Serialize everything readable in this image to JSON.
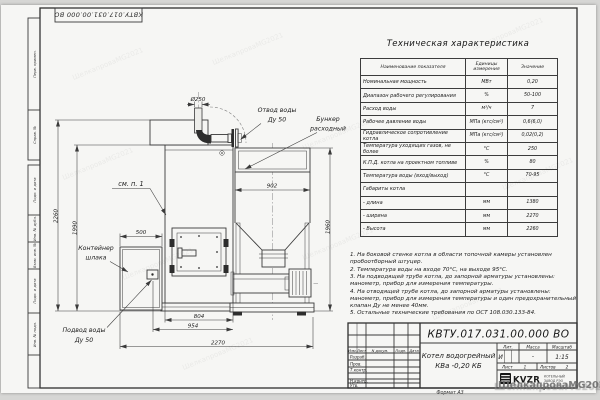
{
  "sheet": {
    "stamp_top": "КВТУ.017.031.00.000 ВО",
    "format_label": "Формат А3",
    "margin_labels": [
      "Перв. примен.",
      "Справ. №",
      "Подп. и дата",
      "Инв. № дубл.",
      "Взам. инв. №",
      "Подп. и дата",
      "Инв. № подл."
    ]
  },
  "spec_table": {
    "title": "Техническая характеристика",
    "columns": [
      "Наименование показателя",
      "Единицы измерения",
      "Значение"
    ],
    "rows": [
      {
        "name": "Номинальная мощность",
        "unit": "МВт",
        "value": "0,20"
      },
      {
        "name": "Диапазон рабочего регулирования",
        "unit": "%",
        "value": "50-100"
      },
      {
        "name": "Расход воды",
        "unit": "м³/ч",
        "value": "7"
      },
      {
        "name": "Рабочее давление воды",
        "unit": "МПа (кгс/см²)",
        "value": "0,6(6,0)"
      },
      {
        "name": "Гидравлическое сопротивление котла",
        "unit": "МПа (кгс/см²)",
        "value": "0,02(0,2)"
      },
      {
        "name": "Температура уходящих газов, не более",
        "unit": "°С",
        "value": "250"
      },
      {
        "name": "К.П.Д. котла на проектном топливе",
        "unit": "%",
        "value": "80"
      },
      {
        "name": "Температура воды (вход/выход)",
        "unit": "°С",
        "value": "70-95"
      },
      {
        "name": "Габариты котла",
        "unit": "",
        "value": ""
      },
      {
        "name": "- длина",
        "unit": "мм",
        "value": "1380"
      },
      {
        "name": "- ширина",
        "unit": "мм",
        "value": "2270"
      },
      {
        "name": "- Высота",
        "unit": "мм",
        "value": "2260"
      }
    ]
  },
  "notes": {
    "items": [
      "1. На боковой стенке котла в области топочной камеры установлен пробоотборный штуцер.",
      "2. Температура воды на входе 70°С, на выходе 95°С.",
      "3. На подводящей трубе котла, до запорной арматуры установлены: манометр, прибор для измерения температуры.",
      "4. На отводящей трубе котла, до запорной арматуры установлены: манометр, прибор для измерения температуры и один предохранительный клапан Ду не менее 40мм.",
      "5. Остальные технические требования по ОСТ 108.030.133-84."
    ]
  },
  "drawing": {
    "dims": {
      "d_chimney": "Ø250",
      "w_hopper": "902",
      "w_container": "500",
      "w_door_base": "804",
      "w_inlet": "954",
      "w_total": "2270",
      "h_total": "2260",
      "h_body": "1990",
      "h_hopper": "1960"
    },
    "labels": {
      "outlet_1": "Отвод воды",
      "outlet_2": "Ду 50",
      "hopper_1": "Бункер",
      "hopper_2": "расходный",
      "see_note": "см. п. 1",
      "container_1": "Контейнер",
      "container_2": "шлака",
      "inlet_1": "Подвод воды",
      "inlet_2": "Ду 50"
    }
  },
  "title_block": {
    "doc_number": "КВТУ.017.031.00.000  ВО",
    "product_1": "Котел водогрейный",
    "product_2": "КВа -0,20  КБ",
    "lit_header": "Лит.",
    "mass_header": "Масса",
    "scale_header": "Масштаб",
    "lit_value": "И",
    "mass_value": "-",
    "scale_value": "1:15",
    "sheet_label": "Лист",
    "sheet_value": "1",
    "sheets_label": "Листов",
    "sheets_value": "2",
    "change_cols": [
      "Изм.",
      "Лист",
      "N докум.",
      "Подп.",
      "Дата"
    ],
    "sign_rows": [
      "Разраб.",
      "Пров.",
      "Т.контр.",
      "Н.контр.",
      "Утв."
    ],
    "logo": {
      "text": "KVZR",
      "sub_1": "КОТЕЛЬНЫЙ",
      "sub_2": "ЗАВОД РЭО"
    }
  },
  "watermark": {
    "text": "ШелкапроваMG2021"
  }
}
